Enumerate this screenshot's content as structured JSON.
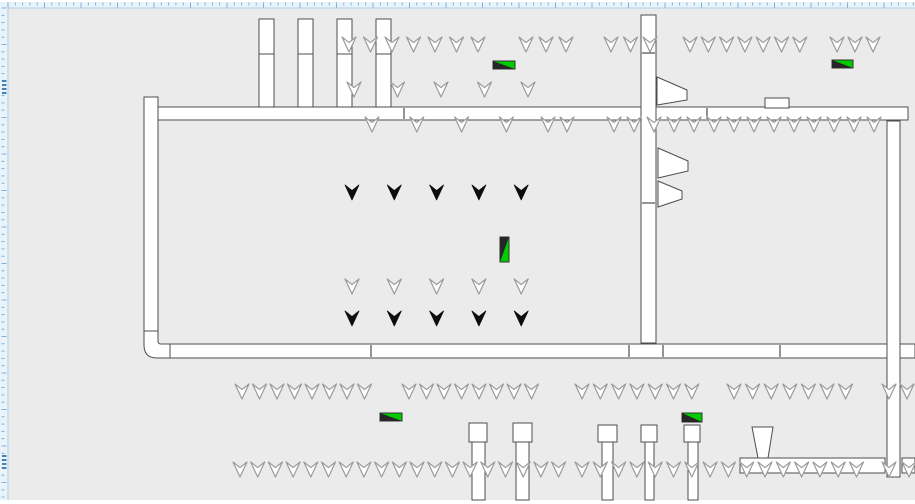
{
  "window": {
    "width": 915,
    "height": 504,
    "background": "#ffffff"
  },
  "canvas": {
    "x": 8,
    "y": 8,
    "width": 907,
    "height": 492,
    "background": "#ebebeb"
  },
  "rulers": {
    "background": "#e9f3fa",
    "border_color": "#aecfe6",
    "tick_color": "#78abd3",
    "marker_color": "#4a7fb5",
    "top": {
      "x": 0,
      "y": 2,
      "length": 915,
      "thickness": 6
    },
    "left": {
      "x": 0,
      "y": 2,
      "length": 498,
      "thickness": 8
    },
    "minor_spacing": 7.3,
    "major_every": 5,
    "left_markers": [
      {
        "y": 80,
        "count": 4
      },
      {
        "y": 455,
        "count": 4
      }
    ]
  },
  "palette": {
    "wall_fill": "#ffffff",
    "wall_stroke": "#4d4d4d",
    "chevron_stroke": "#9a9a9a",
    "chevron_fill_outline": "#ffffff",
    "chevron_fill_solid": "#0d0d0d",
    "green": "#00cc00",
    "dark": "#262626",
    "label_stroke": "#333333"
  },
  "walls": {
    "rects": [
      {
        "id": "left-wall",
        "x": 144,
        "y": 97,
        "w": 14,
        "h": 235
      },
      {
        "id": "top-wall",
        "x": 158,
        "y": 107,
        "w": 750,
        "h": 13
      },
      {
        "id": "center-wall",
        "x": 641,
        "y": 15,
        "w": 15,
        "h": 328
      },
      {
        "id": "bottom-wall",
        "x": 170,
        "y": 344,
        "w": 745,
        "h": 14
      },
      {
        "id": "right-wall",
        "x": 887,
        "y": 121,
        "w": 13,
        "h": 356
      },
      {
        "id": "door-block",
        "x": 765,
        "y": 98,
        "w": 24,
        "h": 10
      },
      {
        "id": "bottom-right-bar",
        "x": 740,
        "y": 458,
        "w": 145,
        "h": 15
      },
      {
        "id": "bottom-right-bar-end",
        "x": 902,
        "y": 458,
        "w": 13,
        "h": 15
      }
    ],
    "corner_path": "M158,331 L158,341 Q158,344 161,344 L170,344 L170,358 L157,358 Q144,358 144,345 L144,331 Z",
    "joints": [
      {
        "x1": 404,
        "y1": 108,
        "x2": 404,
        "y2": 119
      },
      {
        "x1": 707,
        "y1": 108,
        "x2": 707,
        "y2": 119
      },
      {
        "x1": 371,
        "y1": 345,
        "x2": 371,
        "y2": 357
      },
      {
        "x1": 629,
        "y1": 345,
        "x2": 629,
        "y2": 357
      },
      {
        "x1": 663,
        "y1": 345,
        "x2": 663,
        "y2": 357
      },
      {
        "x1": 780,
        "y1": 345,
        "x2": 780,
        "y2": 357
      },
      {
        "x1": 642,
        "y1": 53,
        "x2": 655,
        "y2": 53
      },
      {
        "x1": 642,
        "y1": 203,
        "x2": 655,
        "y2": 203
      }
    ]
  },
  "columns": {
    "top": [
      {
        "x": 259,
        "y": 19,
        "w": 15,
        "h": 88,
        "split": 54
      },
      {
        "x": 298,
        "y": 19,
        "w": 15,
        "h": 88,
        "split": 54
      },
      {
        "x": 337,
        "y": 19,
        "w": 15,
        "h": 88,
        "split": 54
      },
      {
        "x": 376,
        "y": 19,
        "w": 15,
        "h": 88,
        "split": 54
      }
    ],
    "bottom": [
      {
        "cap": {
          "x": 469,
          "y": 423,
          "w": 18,
          "h": 19
        },
        "shaft": {
          "x": 472,
          "y": 442,
          "w": 13,
          "h": 58
        }
      },
      {
        "cap": {
          "x": 513,
          "y": 423,
          "w": 19,
          "h": 19
        },
        "shaft": {
          "x": 516,
          "y": 442,
          "w": 13,
          "h": 58
        }
      },
      {
        "cap": {
          "x": 598,
          "y": 425,
          "w": 19,
          "h": 17
        },
        "shaft": {
          "x": 602,
          "y": 442,
          "w": 11,
          "h": 58
        }
      },
      {
        "cap": {
          "x": 641,
          "y": 425,
          "w": 16,
          "h": 17
        },
        "shaft": {
          "x": 645,
          "y": 442,
          "w": 9,
          "h": 58
        }
      },
      {
        "cap": {
          "x": 684,
          "y": 425,
          "w": 16,
          "h": 17
        },
        "shaft": {
          "x": 688,
          "y": 442,
          "w": 10,
          "h": 58
        }
      }
    ]
  },
  "fixtures": {
    "horns": [
      "657,77 687,90 687,100 657,105",
      "658,148 688,161 688,171 658,178",
      "658,181 682,191 682,199 658,207"
    ],
    "funnel": "752,427 773,427 768,458 758,458"
  },
  "chevrons": {
    "w": 14,
    "h": 15,
    "groups": [
      {
        "x": 342,
        "y": 37,
        "n": 7,
        "dx": 21.5,
        "style": "outline"
      },
      {
        "x": 519,
        "y": 37,
        "n": 3,
        "dx": 20,
        "style": "outline"
      },
      {
        "x": 604,
        "y": 37,
        "n": 3,
        "dx": 19.5,
        "style": "outline"
      },
      {
        "x": 683,
        "y": 37,
        "n": 7,
        "dx": 18.3,
        "style": "outline"
      },
      {
        "x": 830,
        "y": 37,
        "n": 3,
        "dx": 18,
        "style": "outline"
      },
      {
        "x": 347,
        "y": 82,
        "n": 5,
        "dx": 43.5,
        "style": "outline"
      },
      {
        "x": 365,
        "y": 117,
        "n": 4,
        "dx": 44.8,
        "style": "outline"
      },
      {
        "x": 541,
        "y": 117,
        "n": 2,
        "dx": 19,
        "style": "outline"
      },
      {
        "x": 607,
        "y": 117,
        "n": 14,
        "dx": 20,
        "style": "outline"
      },
      {
        "x": 345,
        "y": 185,
        "n": 5,
        "dx": 42.3,
        "style": "solid"
      },
      {
        "x": 345,
        "y": 279,
        "n": 5,
        "dx": 42.3,
        "style": "outline"
      },
      {
        "x": 345,
        "y": 311,
        "n": 5,
        "dx": 42.3,
        "style": "solid"
      },
      {
        "x": 235,
        "y": 384,
        "n": 8,
        "dx": 17.5,
        "style": "outline"
      },
      {
        "x": 402,
        "y": 384,
        "n": 8,
        "dx": 17.5,
        "style": "outline"
      },
      {
        "x": 575,
        "y": 384,
        "n": 7,
        "dx": 18.3,
        "style": "outline"
      },
      {
        "x": 727,
        "y": 384,
        "n": 7,
        "dx": 18.6,
        "style": "outline"
      },
      {
        "x": 882,
        "y": 384,
        "n": 2,
        "dx": 18,
        "style": "outline"
      },
      {
        "x": 233,
        "y": 462,
        "n": 19,
        "dx": 17.7,
        "style": "outline"
      },
      {
        "x": 575,
        "y": 462,
        "n": 16,
        "dx": 18.3,
        "style": "outline"
      },
      {
        "x": 882,
        "y": 462,
        "n": 2,
        "dx": 20,
        "style": "outline"
      }
    ]
  },
  "labels": [
    {
      "x": 493,
      "y": 61,
      "w": 22,
      "h": 8,
      "orient": "h"
    },
    {
      "x": 832,
      "y": 60,
      "w": 21,
      "h": 8,
      "orient": "h"
    },
    {
      "x": 380,
      "y": 413,
      "w": 22,
      "h": 8,
      "orient": "h"
    },
    {
      "x": 682,
      "y": 413,
      "w": 20,
      "h": 9,
      "orient": "h"
    },
    {
      "x": 500,
      "y": 237,
      "w": 9,
      "h": 25,
      "orient": "v"
    }
  ]
}
